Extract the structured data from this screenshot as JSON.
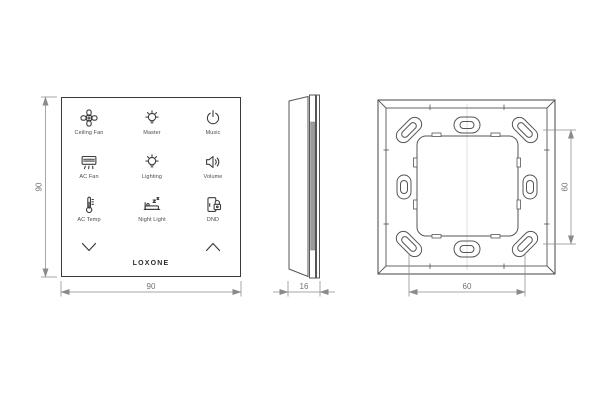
{
  "front_view": {
    "buttons": [
      {
        "label": "Ceiling Fan",
        "icon": "ceiling-fan-icon"
      },
      {
        "label": "Master",
        "icon": "bulb-icon"
      },
      {
        "label": "Music",
        "icon": "power-icon"
      },
      {
        "label": "AC Fan",
        "icon": "ac-unit-icon"
      },
      {
        "label": "Lighting",
        "icon": "bulb-icon"
      },
      {
        "label": "Volume",
        "icon": "speaker-icon"
      },
      {
        "label": "AC Temp",
        "icon": "thermometer-icon"
      },
      {
        "label": "Night Light",
        "icon": "bed-icon"
      },
      {
        "label": "DND",
        "icon": "door-lock-icon"
      }
    ],
    "nav": {
      "down": "chevron-down-icon",
      "up": "chevron-up-icon"
    },
    "brand": "LOXONE",
    "width_dim": "90",
    "height_dim": "90"
  },
  "side_view": {
    "depth_dim": "16"
  },
  "back_view": {
    "screw_span_h_dim": "60",
    "screw_span_v_dim": "60"
  },
  "colors": {
    "outline": "#3a3a3a",
    "drawing_line": "#555555",
    "dimension_line": "#8a8a8a",
    "dimension_text": "#707070",
    "clip_fill": "#9b9b9b",
    "background": "#ffffff"
  }
}
